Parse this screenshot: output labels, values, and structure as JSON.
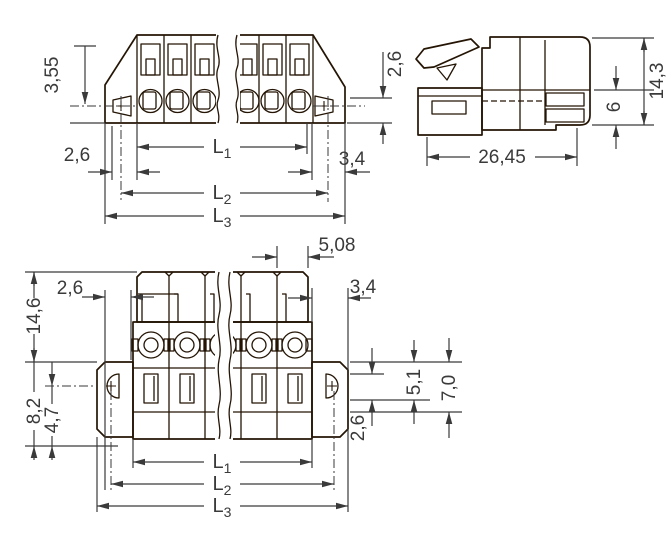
{
  "drawing": {
    "background": "#FFFFFF",
    "colors": {
      "body_orange": "#EE8348",
      "accent_yellow": "#F2E41E",
      "outline_dark": "#241505",
      "dimension_gray": "#3A3A3A",
      "hole_white": "#FFFFFF"
    },
    "views": {
      "front": {
        "name": "front-view-upper",
        "dims": {
          "flange_height": "3,55",
          "pitch_left": "2,6",
          "right_height": "2,6",
          "right_offset": "3,4"
        }
      },
      "side": {
        "name": "side-view",
        "dims": {
          "total_height": "14,3",
          "lower_height": "6",
          "depth": "26,45"
        }
      },
      "back": {
        "name": "back-view-lower",
        "dims": {
          "pole_pitch": "5,08",
          "pitch_left": "2,6",
          "right_offset": "3,4",
          "total_height": "14,6",
          "flange_height": "8,2",
          "flange_inner": "4,7",
          "slot_height": "2,6",
          "mid_height": "5,1",
          "lower_total": "7,0"
        }
      }
    },
    "lengths": {
      "base": "L",
      "sub1": "1",
      "sub2": "2",
      "sub3": "3"
    }
  }
}
